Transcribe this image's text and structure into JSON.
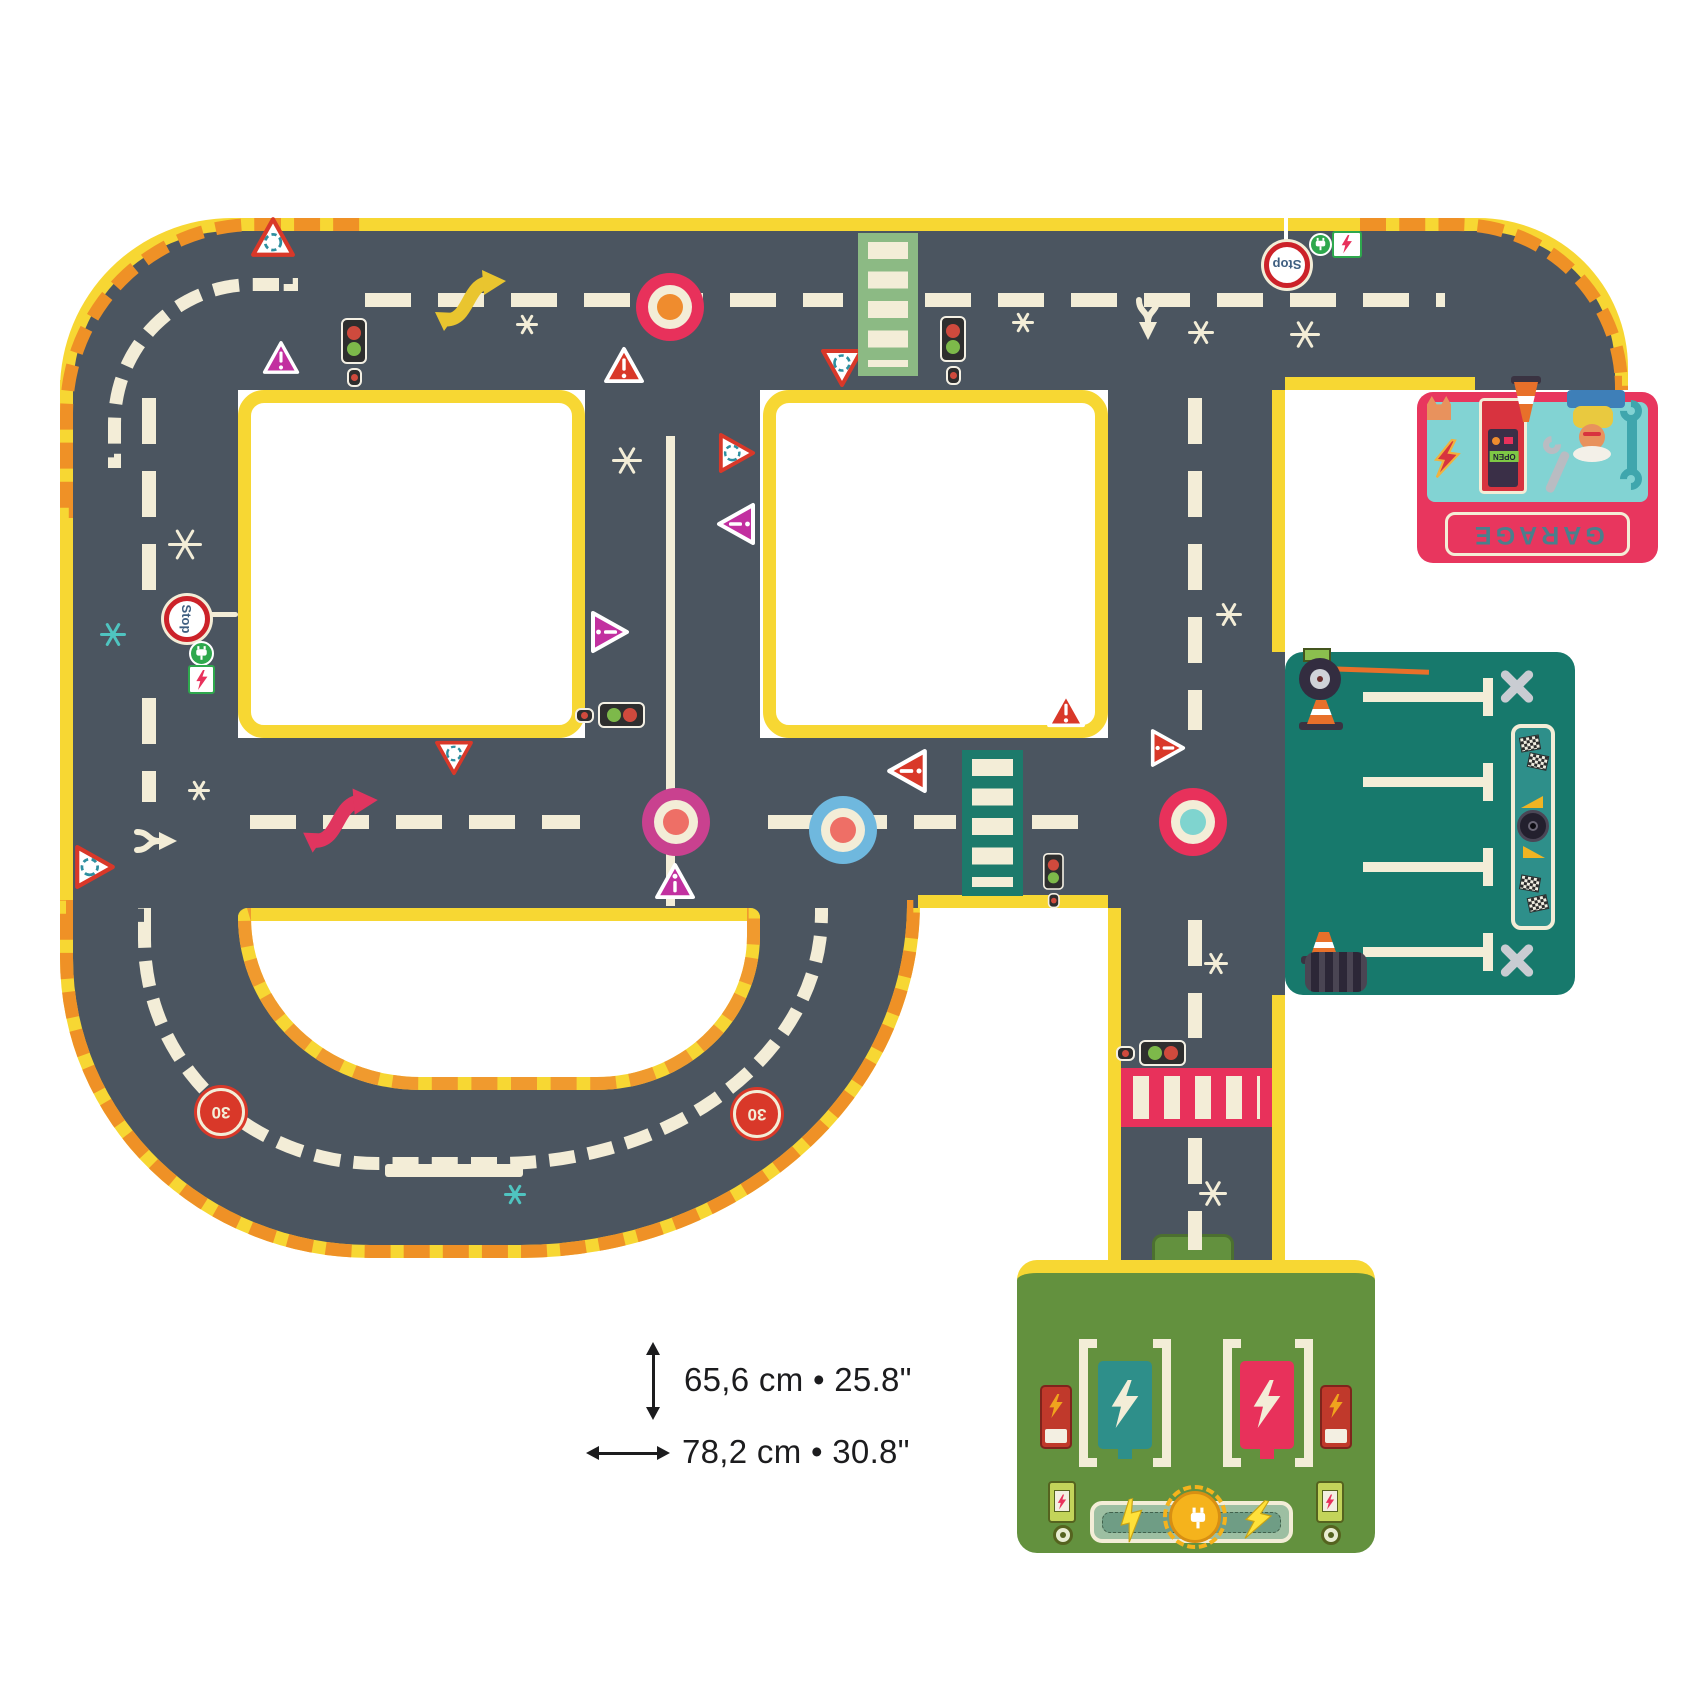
{
  "product_dimensions": {
    "height_label": "65,6 cm • 25.8\"",
    "width_label": "78,2 cm • 30.8\""
  },
  "labels": {
    "garage": "GARAGE",
    "stop": "Stop",
    "speed_30": "30",
    "open": "OPEN"
  },
  "colors": {
    "road": "#4b5560",
    "edge_yellow": "#f7d733",
    "hazard_orange": "#ef9126",
    "marking_cream": "#f3edd7",
    "crimson": "#e8315b",
    "magenta_sign": "#c230a0",
    "red_sign": "#d93829",
    "green_crosswalk": "#8cba84",
    "teal_crosswalk": "#1c7a6b",
    "parking_teal": "#17796c",
    "station_green": "#63913e",
    "garage_pink": "#e8365e",
    "garage_teal": "#82d3d3",
    "roundabout_blue": "#6fb8de",
    "roundabout_teal": "#7fd4cf",
    "arrow_yellow": "#e9c52f",
    "arrow_crimson": "#e0355f"
  },
  "markings": {
    "dashes_h": [
      [
        365,
        293,
        478
      ],
      [
        925,
        293,
        520
      ],
      [
        250,
        815,
        330
      ],
      [
        768,
        815,
        188
      ],
      [
        1032,
        815,
        66
      ]
    ],
    "dashes_v": [
      [
        142,
        398,
        192
      ],
      [
        142,
        698,
        104
      ],
      [
        1188,
        398,
        332
      ],
      [
        1188,
        920,
        118
      ],
      [
        1188,
        1138,
        112
      ]
    ],
    "solid_v": [
      [
        666,
        436,
        470,
        9
      ]
    ],
    "solid_h": [
      [
        385,
        1164,
        138,
        13
      ],
      [
        208,
        612,
        30,
        5
      ]
    ],
    "poles_v": [
      [
        1284,
        218,
        26,
        4
      ]
    ],
    "stars": [
      [
        516,
        312,
        22,
        "cream"
      ],
      [
        1012,
        310,
        22,
        "cream"
      ],
      [
        1188,
        318,
        26,
        "cream"
      ],
      [
        1290,
        318,
        30,
        "cream"
      ],
      [
        612,
        444,
        30,
        "cream"
      ],
      [
        168,
        526,
        34,
        "cream"
      ],
      [
        100,
        620,
        26,
        "teal"
      ],
      [
        1216,
        600,
        26,
        "cream"
      ],
      [
        188,
        778,
        22,
        "cream"
      ],
      [
        1204,
        950,
        24,
        "cream"
      ],
      [
        1199,
        1178,
        28,
        "cream"
      ],
      [
        504,
        1182,
        22,
        "teal"
      ]
    ],
    "roundabouts": [
      [
        636,
        273,
        68,
        "#e8315b",
        "#ef8c2e"
      ],
      [
        642,
        788,
        68,
        "#c9418f",
        "#ee6f66"
      ],
      [
        809,
        796,
        68,
        "#6fb8de",
        "#ee6f66"
      ],
      [
        1159,
        788,
        68,
        "#e8315b",
        "#7fd4cf"
      ]
    ],
    "triangles": [
      [
        250,
        216,
        46,
        0,
        "outline",
        "@"
      ],
      [
        262,
        340,
        38,
        0,
        "magenta",
        "!"
      ],
      [
        603,
        346,
        42,
        0,
        "red",
        "!"
      ],
      [
        820,
        348,
        44,
        180,
        "outline",
        "@"
      ],
      [
        716,
        434,
        42,
        90,
        "outline",
        "@"
      ],
      [
        714,
        504,
        44,
        -90,
        "magenta",
        "!"
      ],
      [
        588,
        612,
        44,
        90,
        "magenta",
        "!"
      ],
      [
        654,
        862,
        42,
        0,
        "magenta",
        "i"
      ],
      [
        884,
        750,
        46,
        -90,
        "red",
        "!"
      ],
      [
        1046,
        692,
        40,
        0,
        "red",
        "!"
      ],
      [
        1148,
        730,
        40,
        90,
        "red",
        "!"
      ],
      [
        434,
        740,
        40,
        180,
        "outline",
        "@"
      ],
      [
        72,
        846,
        46,
        90,
        "outline",
        "@"
      ]
    ],
    "circle_signs": [
      [
        164,
        596,
        46,
        90,
        "stop"
      ],
      [
        1264,
        242,
        46,
        180,
        "stop"
      ],
      [
        197,
        1088,
        48,
        180,
        "s30"
      ],
      [
        733,
        1090,
        48,
        180,
        "s30"
      ]
    ],
    "lights_v": [
      [
        341,
        318,
        1
      ],
      [
        940,
        316,
        1
      ],
      [
        1043,
        853,
        0.8
      ]
    ],
    "lights_h": [
      [
        575,
        702,
        1
      ],
      [
        1116,
        1040,
        1
      ]
    ],
    "crosswalks": [
      [
        858,
        233,
        60,
        143,
        "#8cba84",
        "h"
      ],
      [
        962,
        750,
        61,
        146,
        "#1c7a6b",
        "h"
      ],
      [
        1121,
        1068,
        151,
        59,
        "#e8315b",
        "v"
      ]
    ],
    "s_arrows": [
      [
        432,
        268,
        78,
        64,
        "#e9c52f"
      ],
      [
        300,
        786,
        82,
        68,
        "#e0355f"
      ]
    ],
    "forks": [
      [
        1128,
        296,
        0
      ],
      [
        136,
        818,
        -90
      ]
    ],
    "ev_circles": [
      [
        189,
        641,
        25
      ],
      [
        1309,
        233,
        23
      ]
    ],
    "ev_rects": [
      [
        188,
        665,
        27,
        29
      ],
      [
        1332,
        231,
        30,
        27
      ]
    ]
  }
}
